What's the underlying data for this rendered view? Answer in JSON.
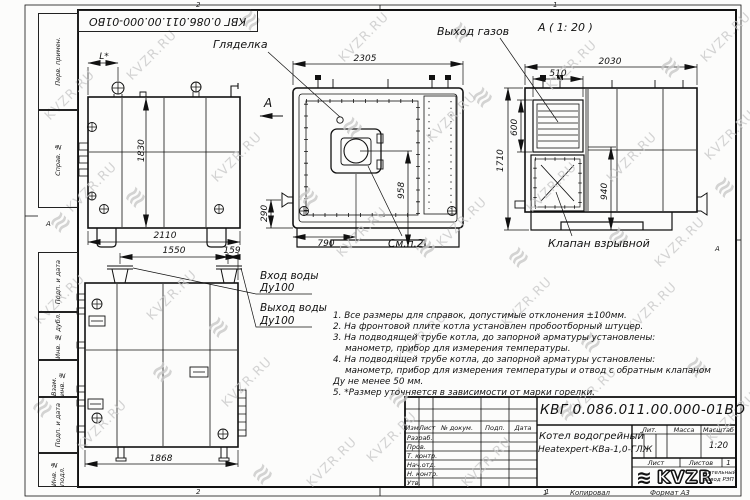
{
  "sheet": {
    "designation": "КВГ 0.086.011.00.000-01ВО",
    "zones": {
      "left": "2",
      "right": "1"
    },
    "zone_row_letter": "А",
    "margin_labels": [
      "Перв. примен.",
      "Справ. №",
      "Подп. и дата",
      "Инв. № дубл.",
      "Взам. инв. №",
      "Подп. и дата",
      "Инв. № подл."
    ],
    "footer": {
      "sheet_no": "1",
      "copied": "Копировал",
      "format": "Формат А3"
    }
  },
  "views": {
    "side_left": {
      "dim_top": "L*",
      "dim_height": "1830",
      "dim_width": "2110",
      "view_arrow": "А"
    },
    "front": {
      "label_sight": "Гляделка",
      "dim_width": "2305",
      "dim_pipe": "290",
      "dim_burner_offset": "790",
      "dim_burner_height": "958",
      "label_note_ref": "См.п.2"
    },
    "side_right": {
      "title": "А ( 1: 20 )",
      "label_gas_outlet": "Выход газов",
      "label_valve": "Клапан взрывной",
      "dim_width": "2030",
      "dim_louver_width": "510",
      "dim_louver_height": "600",
      "dim_height": "1710",
      "dim_inner": "940"
    },
    "rear": {
      "dim_top_left": "1550",
      "dim_top_right": "159",
      "dim_width": "1868",
      "label_inlet": "Вход воды",
      "label_inlet_dn": "Ду100",
      "label_outlet": "Выход воды",
      "label_outlet_dn": "Ду100"
    }
  },
  "notes": [
    {
      "indent": 0,
      "text": "1. Все размеры для справок, допустимые отклонения ±100мм."
    },
    {
      "indent": 0,
      "text": "2. На фронтовой плите котла установлен пробоотборный штуцер."
    },
    {
      "indent": 0,
      "text": "3. На подводящей трубе котла, до запорной арматуры установлены:"
    },
    {
      "indent": 1,
      "text": "манометр, прибор для измерения температуры."
    },
    {
      "indent": 0,
      "text": "4. На подводящей трубе котла, до запорной арматуры установлены:"
    },
    {
      "indent": 1,
      "text": "манометр, прибор для измерения температуры и отвод с обратным клапаном"
    },
    {
      "indent": 0,
      "text": "Ду не менее 50 мм."
    },
    {
      "indent": 0,
      "text": "5. *Размер уточняется в зависимости от марки горелки."
    }
  ],
  "titleblock": {
    "product_name_line1": "Котел водогрейный",
    "product_name_line2": "Heatexpert-КВа-1,0-ГЛЖ",
    "col_headers": [
      "Изм",
      "Лист",
      "№ докум.",
      "Подп.",
      "Дата"
    ],
    "row_labels": [
      "Разраб.",
      "Пров.",
      "Т. контр.",
      "Нач.отд.",
      "Н. контр.",
      "Утв."
    ],
    "lit_label": "Лит.",
    "mass_label": "Масса",
    "scale_label": "Масштаб",
    "scale_value": "1:20",
    "sheet_label": "Лист",
    "sheets_label": "Листов",
    "sheets_value": "1",
    "company_logo": "KVZR",
    "company_name_line1": "Котельный",
    "company_name_line2": "завод РЭП"
  },
  "watermark": {
    "text": "KVZR.RU",
    "color": "#c6c6c6"
  }
}
